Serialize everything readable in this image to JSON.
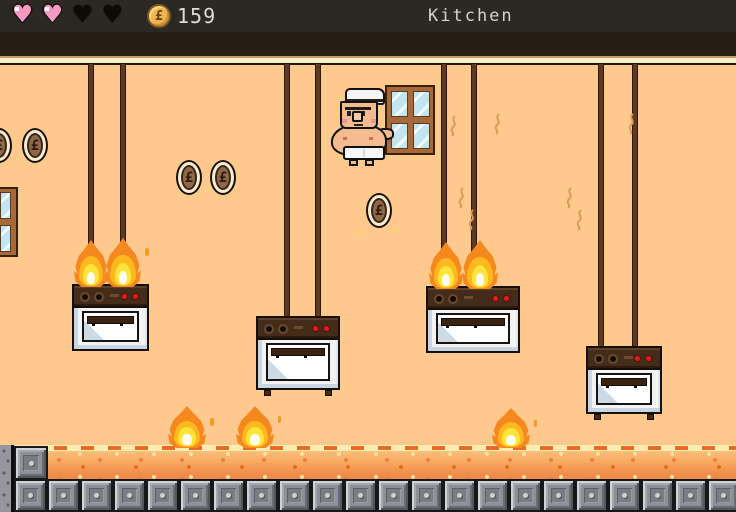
{
  "hud": {
    "hearts": {
      "total": 4,
      "filled": 2
    },
    "coin_counter": {
      "symbol": "£",
      "value": "159"
    },
    "level_title": "Kitchen"
  },
  "level": {
    "name": "Kitchen",
    "coin_symbol": "£",
    "coins_visible": 5,
    "stoves": [
      {
        "position": "left",
        "state": "burning",
        "hanging": true
      },
      {
        "position": "center-left",
        "state": "idle",
        "hanging": true
      },
      {
        "position": "center-right",
        "state": "burning",
        "hanging": true
      },
      {
        "position": "right",
        "state": "idle",
        "hanging": true
      }
    ],
    "ground_fires": 3,
    "character": {
      "description": "shirtless chef standing by window"
    }
  },
  "ground": {
    "block_count": 22
  },
  "palette": {
    "hud_bg": "#2c2824",
    "wall": "#fdc98c",
    "heart_filled": "#f79ac2",
    "heart_empty": "#0d0b09",
    "flame_outer": "#f68820",
    "flame_mid": "#ffb81e",
    "flame_core": "#ffe43c",
    "ground_orange": "#f0914e",
    "metal_block": "#8f9097",
    "rope": "#5d3a21",
    "coin_face": "#8f6849",
    "window_glass": "#c3e5f0",
    "counter_text": "#dcdcdc"
  }
}
